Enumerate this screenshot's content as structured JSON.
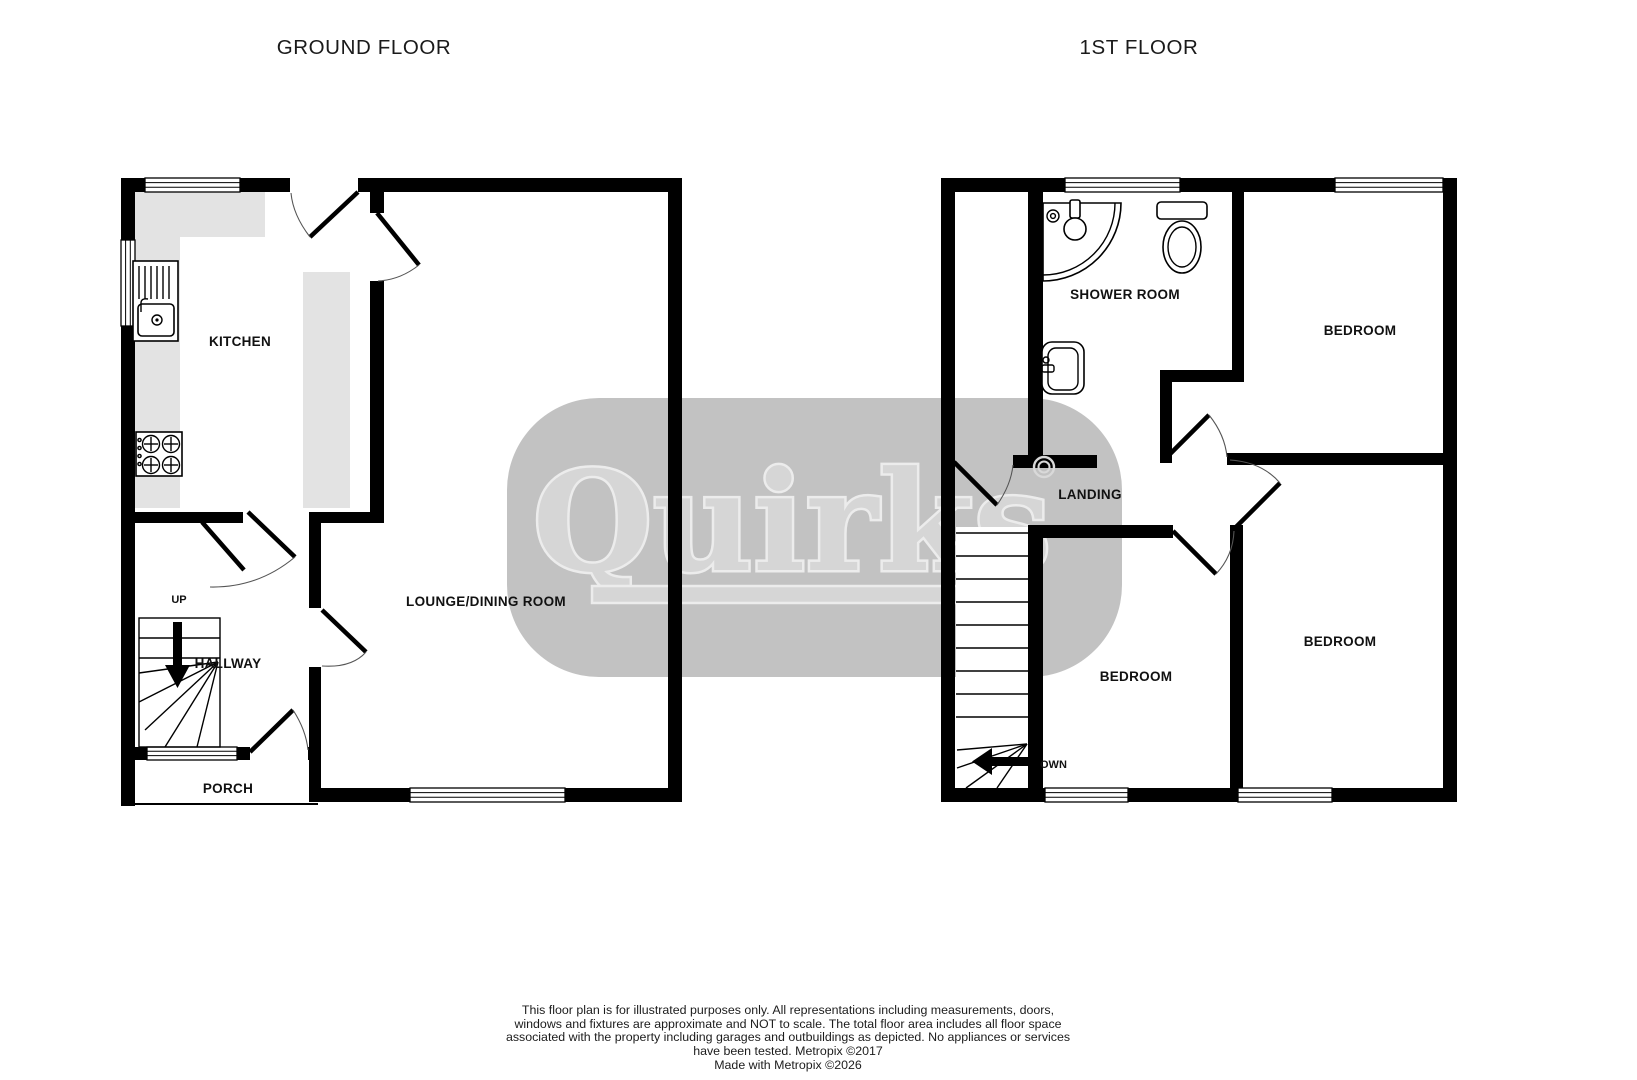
{
  "ground_floor": {
    "title": "GROUND FLOOR",
    "rooms": {
      "kitchen": "KITCHEN",
      "lounge": "LOUNGE/DINING ROOM",
      "hallway": "HALLWAY",
      "porch": "PORCH"
    },
    "stairs_label": "UP"
  },
  "first_floor": {
    "title": "1ST FLOOR",
    "rooms": {
      "shower_room": "SHOWER ROOM",
      "landing": "LANDING",
      "bedroom_front": "BEDROOM",
      "bedroom_small": "BEDROOM",
      "bedroom_back": "BEDROOM"
    },
    "stairs_label": "OWN"
  },
  "watermark": {
    "brand": "Quirks",
    "registered_mark": "®",
    "blob_color": "#c2c2c2",
    "letter_color": "#d6d6d6",
    "halo_color": "#ececec"
  },
  "footer": {
    "lines": [
      "This floor plan is for illustrated purposes only. All representations including measurements, doors,",
      "windows and fixtures are approximate and NOT to scale. The total floor area includes all floor space",
      "associated with the property including garages and outbuildings as depicted. No appliances or services",
      "have been tested. Metropix ©2017",
      "Made with Metropix ©2026"
    ]
  },
  "colors": {
    "wall": "#000000",
    "counter": "#e3e3e3",
    "floor": "#ffffff"
  }
}
